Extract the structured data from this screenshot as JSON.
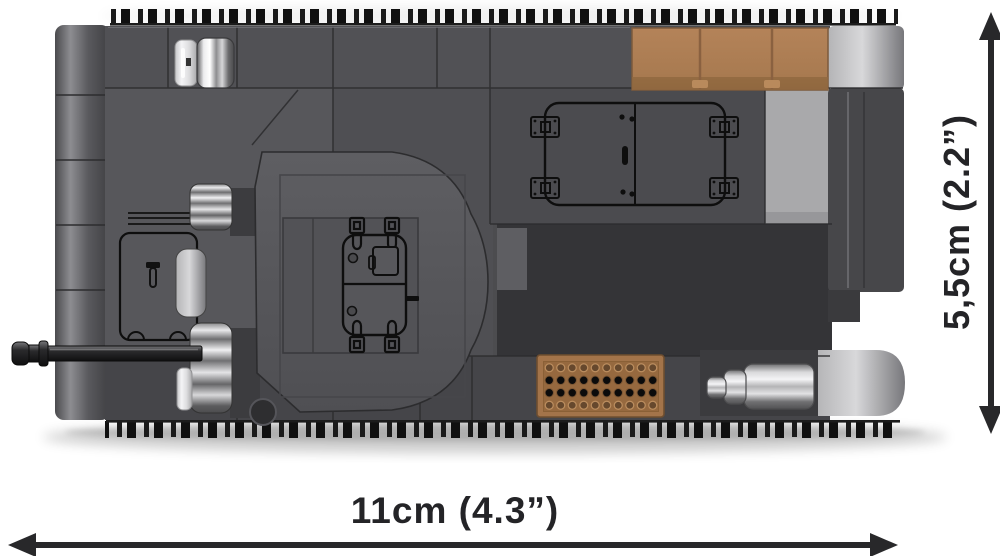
{
  "annotations": {
    "width_label": "11cm (4.3”)",
    "height_label": "5,5cm (2.2”)",
    "arrow_color": "#28282a"
  },
  "palette": {
    "background": "#ffffff",
    "hull_gray": "#4c4c4f",
    "front_hull_gray": "#57575b",
    "engine_deck_gray": "#4b4b4f",
    "panel_dark": "#343437",
    "light_gray_brick": "#a9a9ab",
    "tan_brick": "#ad7e54",
    "grille_tan": "#a3744a",
    "chrome_silver": "#d9d9db",
    "track_black": "#161616",
    "outline_black": "#0e0e0e"
  },
  "illustration": {
    "subject": "building-block tank model, top view",
    "parts": [
      "track-links",
      "left-glacis",
      "hull-deck",
      "turret",
      "turret-hatch",
      "engine-hatch",
      "cargo-box",
      "headlight",
      "gun-barrel",
      "air-intake-grille",
      "exhaust-muffler",
      "rear-fender"
    ]
  }
}
